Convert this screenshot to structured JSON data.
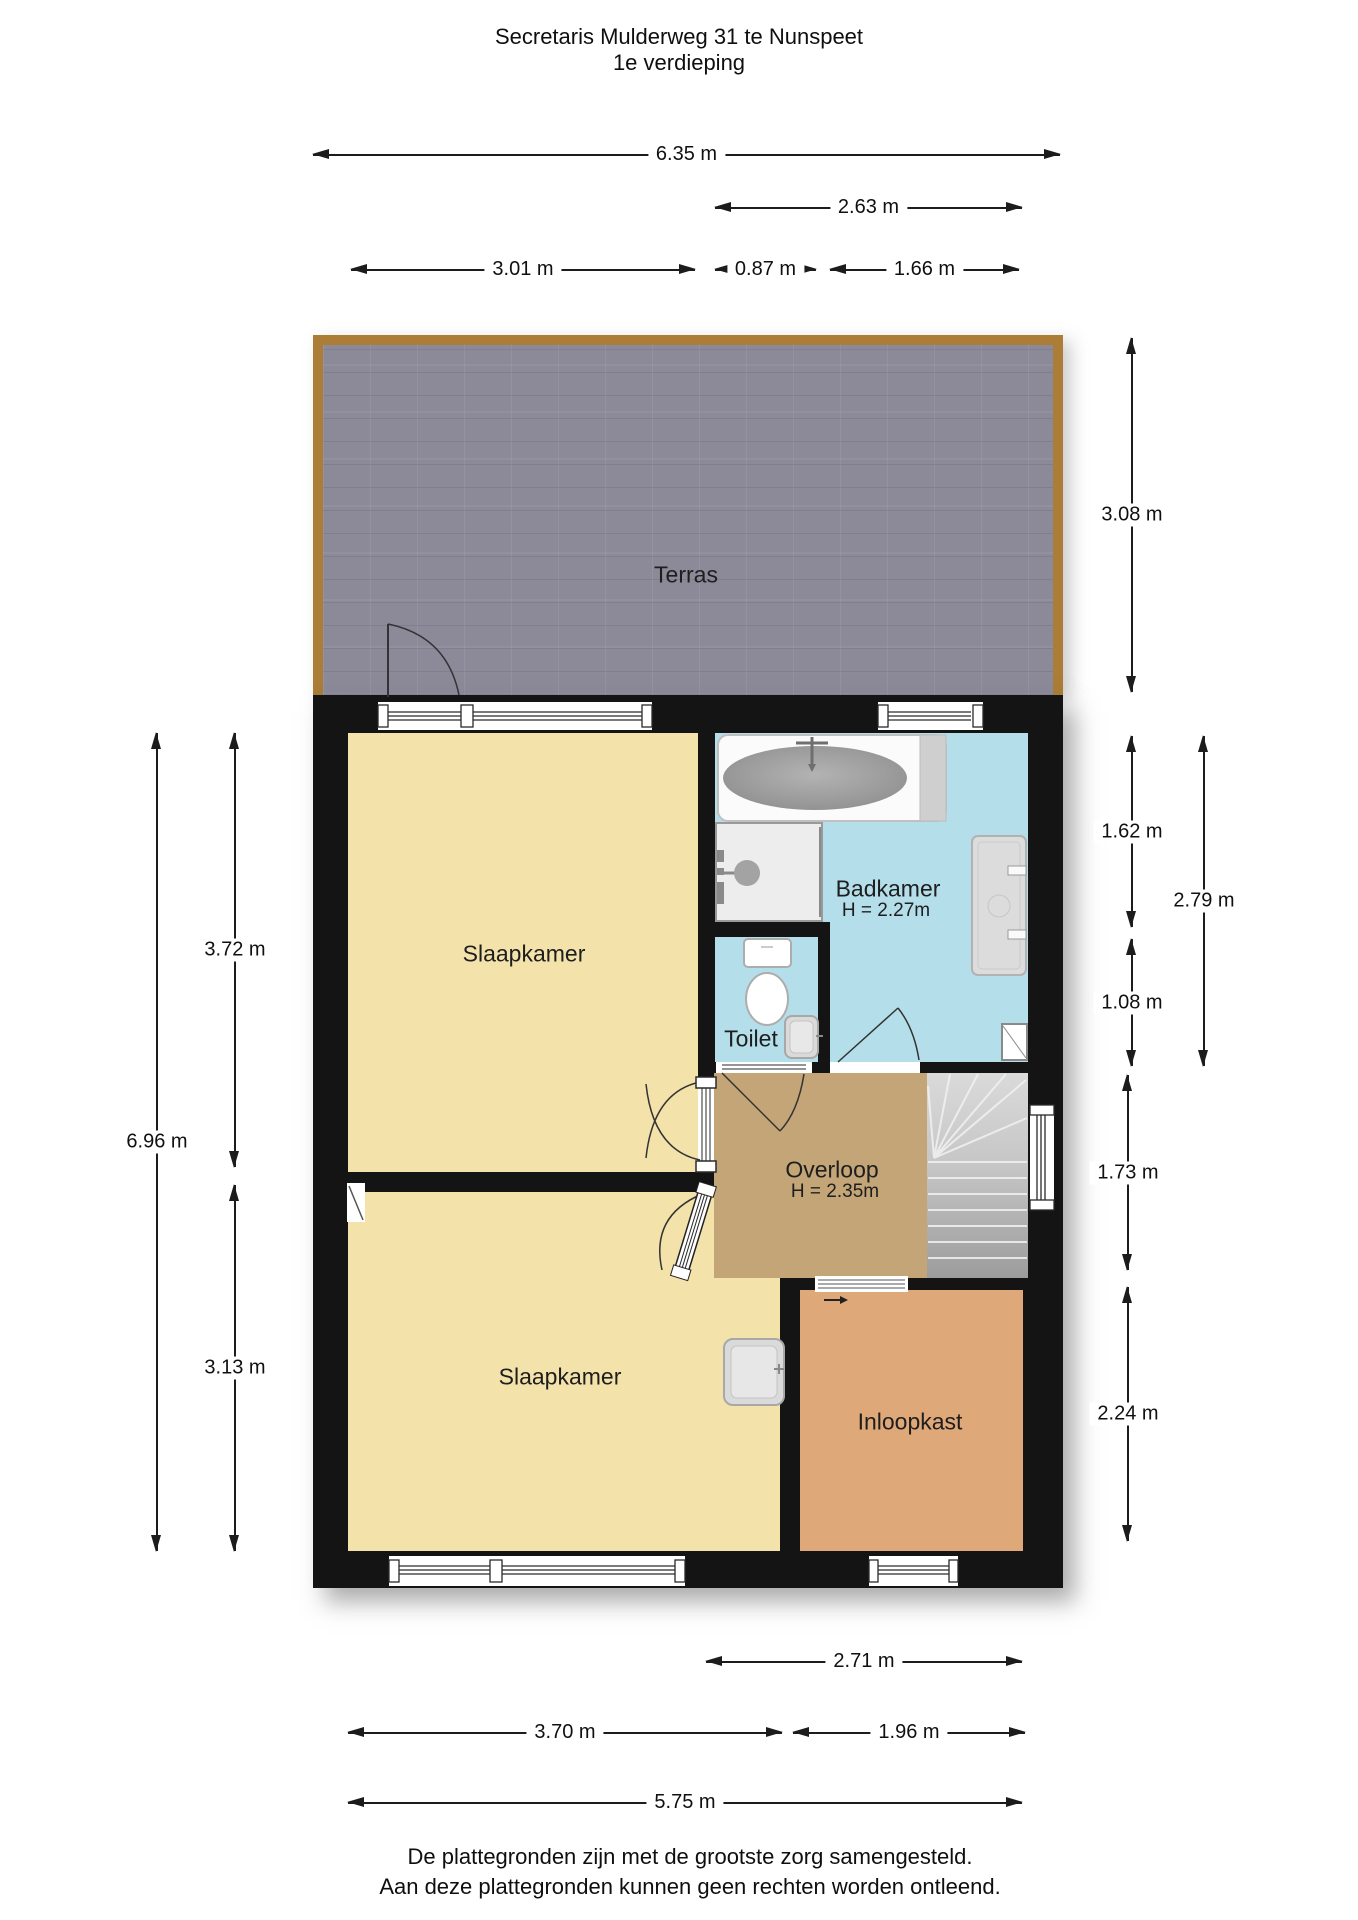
{
  "title": {
    "line1": "Secretaris Mulderweg 31 te Nunspeet",
    "line2": "1e verdieping"
  },
  "rooms": {
    "terras": {
      "label": "Terras"
    },
    "slaapkamer_top": {
      "label": "Slaapkamer"
    },
    "badkamer": {
      "label": "Badkamer",
      "height": "H = 2.27m"
    },
    "toilet": {
      "label": "Toilet"
    },
    "overloop": {
      "label": "Overloop",
      "height": "H = 2.35m"
    },
    "slaapkamer_bottom": {
      "label": "Slaapkamer"
    },
    "inloopkast": {
      "label": "Inloopkast"
    }
  },
  "dimensions": {
    "top": {
      "total": "6.35 m",
      "bath_zone": "2.63 m",
      "bedroom": "3.01 m",
      "shower": "0.87 m",
      "bath": "1.66 m"
    },
    "right": {
      "terras": "3.08 m",
      "bath_upper": "1.62 m",
      "toilet": "1.08 m",
      "bath_total": "2.79 m",
      "overloop": "1.73 m",
      "inloopkast": "2.24 m"
    },
    "left": {
      "total": "6.96 m",
      "bedroom_top": "3.72 m",
      "bedroom_bottom": "3.13 m"
    },
    "bottom": {
      "closet_zone": "2.71 m",
      "bedroom": "3.70 m",
      "closet": "1.96 m",
      "total": "5.75 m"
    }
  },
  "footer": {
    "line1": "De plattegronden zijn met de grootste zorg samengesteld.",
    "line2": "Aan deze plattegronden kunnen geen rechten worden ontleend."
  },
  "colors": {
    "wall": "#141414",
    "terras_tile": "#8c8999",
    "wood_trim": "#ab7d36",
    "bedroom_floor": "#f4e2ab",
    "bathroom_floor": "#b4deea",
    "hall_floor": "#c3a577",
    "closet_floor": "#dfa878",
    "stairs": "#c7c7c7"
  }
}
